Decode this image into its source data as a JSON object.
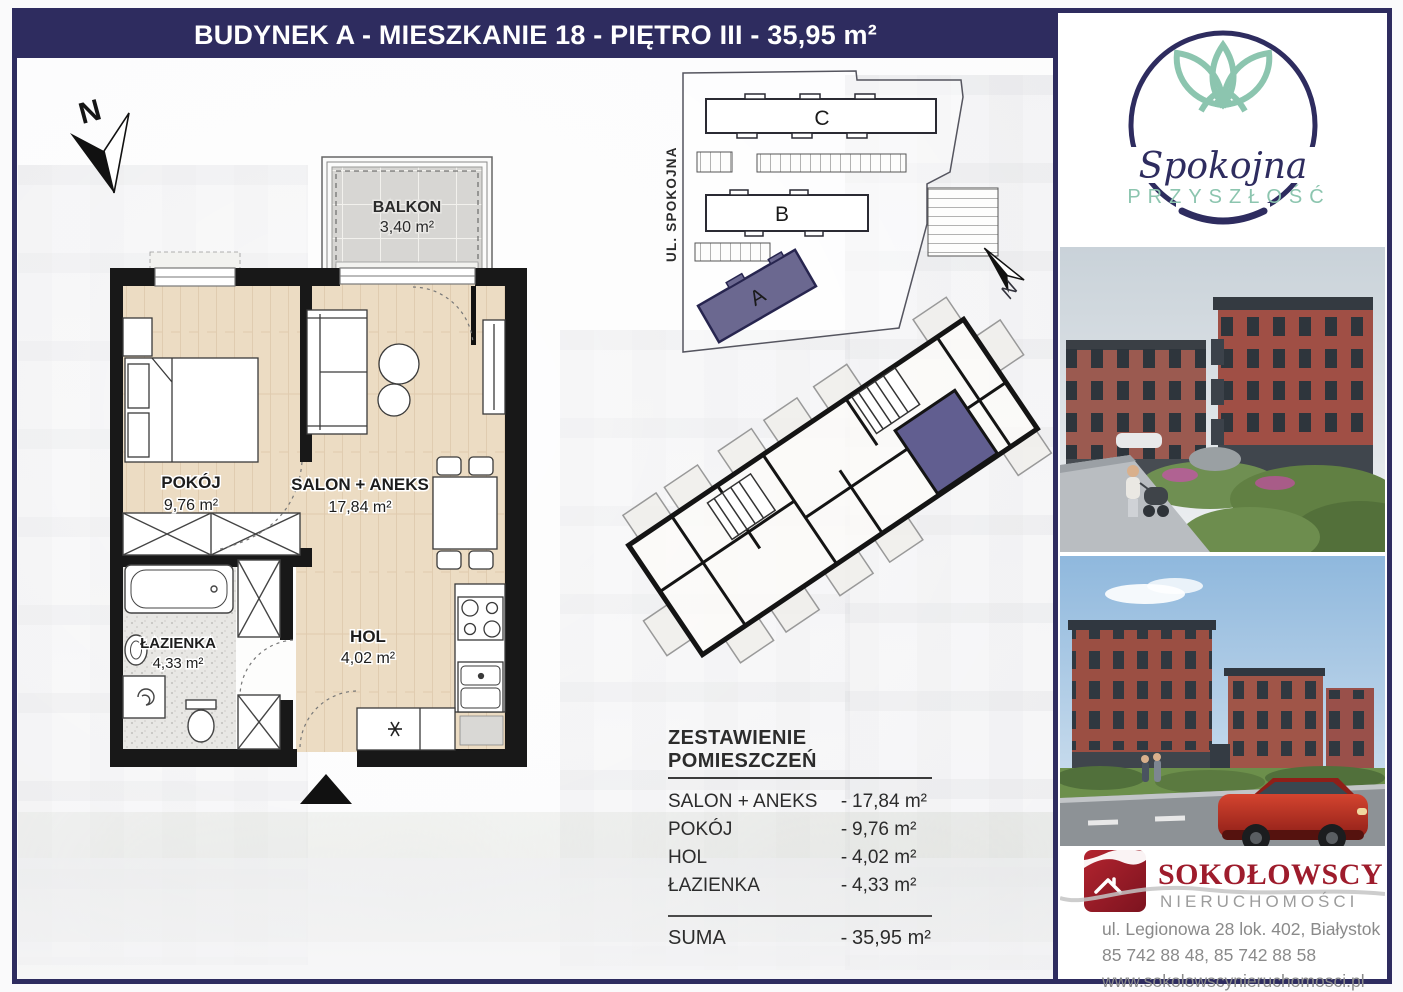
{
  "banner": {
    "title": "BUDYNEK A - MIESZKANIE 18 - PIĘTRO III - 35,95 m²"
  },
  "floor_plan": {
    "compass_label": "N",
    "balcony": {
      "name": "BALKON",
      "area": "3,40 m²"
    },
    "rooms": {
      "pokoj": {
        "name": "POKÓJ",
        "area": "9,76 m²"
      },
      "salon": {
        "name": "SALON + ANEKS",
        "area": "17,84 m²"
      },
      "lazienka": {
        "name": "ŁAZIENKA",
        "area": "4,33 m²"
      },
      "hol": {
        "name": "HOL",
        "area": "4,02 m²"
      }
    }
  },
  "site_plan": {
    "street_label": "UL. SPOKOJNA",
    "compass_label": "N",
    "buildings": {
      "a": "A",
      "b": "B",
      "c": "C"
    },
    "highlighted_building": "A"
  },
  "summary_table": {
    "title": "ZESTAWIENIE POMIESZCZEŃ",
    "dash": "-",
    "rows": [
      {
        "label": "SALON + ANEKS",
        "value": "17,84 m²"
      },
      {
        "label": "POKÓJ",
        "value": "9,76 m²"
      },
      {
        "label": "HOL",
        "value": "4,02 m²"
      },
      {
        "label": "ŁAZIENKA",
        "value": "4,33 m²"
      }
    ],
    "total": {
      "label": "SUMA",
      "value": "35,95 m²"
    }
  },
  "brand_logo": {
    "line1": "Spokojna",
    "line2": "PRZYSZŁOŚĆ"
  },
  "agency": {
    "name": "SOKOŁOWSCY",
    "subtitle": "NIERUCHOMOŚCI",
    "address": "ul. Legionowa 28 lok. 402, Białystok",
    "phones": "85 742 88 48,  85 742 88 58",
    "website": "www.sokolowscynieruchomosci.pl"
  },
  "colors": {
    "navy": "#2e2c5f",
    "highlight_purple": "#615e90",
    "brand_teal": "#8cc5af",
    "agency_red": "#9e1c2c"
  }
}
